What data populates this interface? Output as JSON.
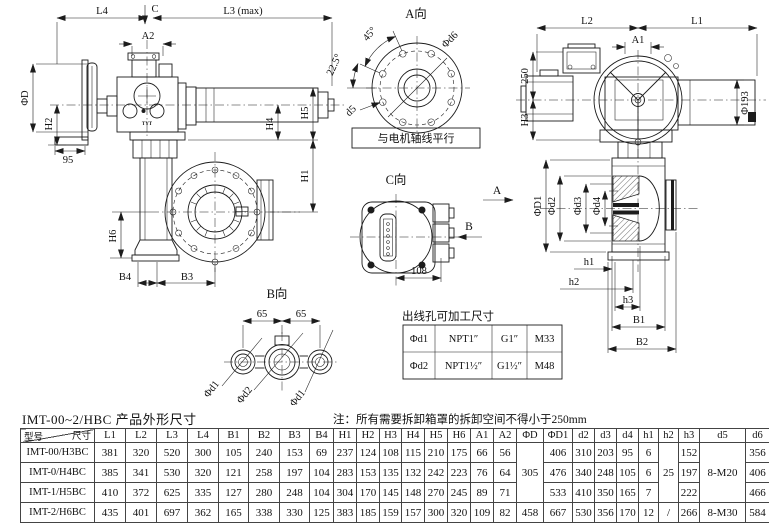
{
  "title": "IMT-00~2/HBC 产品外形尺寸",
  "note": "注：所有需要拆卸箱罩的拆卸空间不得小于250mm",
  "labels": {
    "l4": "L4",
    "c": "C",
    "l3max": "L3 (max)",
    "a2": "A2",
    "phi_d": "ΦD",
    "h2": "H2",
    "n95": "95",
    "h4": "H4",
    "h5": "H5",
    "h1": "H1",
    "h6": "H6",
    "b4": "B4",
    "b3": "B3",
    "brand": "TYT",
    "a_view": "A向",
    "deg45": "45°",
    "deg225": "22.5°",
    "phi_d6": "Φd6",
    "d5": "d5",
    "motor_axis_note": "与电机轴线平行",
    "l2": "L2",
    "l1": "L1",
    "a1": "A1",
    "n250": "250",
    "h3": "H3",
    "phi193": "Φ193",
    "sec_a": "A",
    "phi_d1_cap": "ΦD1",
    "phi_d2": "Φd2",
    "phi_d3": "Φd3",
    "phi_d4": "Φd4",
    "sh1": "h1",
    "sh2": "h2",
    "sh3": "h3",
    "b1": "B1",
    "b2": "B2",
    "c_view": "C向",
    "b_arrow": "B",
    "n108": "108",
    "b_view": "B向",
    "n65a": "65",
    "n65b": "65",
    "g_d1a": "Φd1",
    "g_d2": "Φd2",
    "g_d1b": "Φd1"
  },
  "outlet_table": {
    "title": "出线孔可加工尺寸",
    "rows": [
      [
        "Φd1",
        "NPT1″",
        "G1″",
        "M33"
      ],
      [
        "Φd2",
        "NPT1½″",
        "G1½″",
        "M48"
      ]
    ]
  },
  "main_table": {
    "corner_top": "尺寸",
    "corner_bottom": "型号",
    "headers": [
      "L1",
      "L2",
      "L3",
      "L4",
      "B1",
      "B2",
      "B3",
      "B4",
      "H1",
      "H2",
      "H3",
      "H4",
      "H5",
      "H6",
      "A1",
      "A2",
      "ΦD",
      "ΦD1",
      "d2",
      "d3",
      "d4",
      "h1",
      "h2",
      "h3",
      "d5",
      "d6"
    ],
    "rows": [
      {
        "model": "IMT-00/H3BC",
        "values": [
          "381",
          "320",
          "520",
          "300",
          "105",
          "240",
          "153",
          "69",
          "237",
          "124",
          "108",
          "115",
          "210",
          "175",
          "66",
          "56",
          [
            "305",
            3
          ],
          "406",
          "310",
          "203",
          "95",
          "6",
          [
            "25",
            3
          ],
          "152",
          [
            "8-M20",
            3
          ],
          "356"
        ]
      },
      {
        "model": "IMT-0/H4BC",
        "values": [
          "385",
          "341",
          "530",
          "320",
          "121",
          "258",
          "197",
          "104",
          "283",
          "153",
          "135",
          "132",
          "242",
          "223",
          "76",
          "64",
          null,
          "476",
          "340",
          "248",
          "105",
          "6",
          null,
          "197",
          null,
          "406"
        ]
      },
      {
        "model": "IMT-1/H5BC",
        "values": [
          "410",
          "372",
          "625",
          "335",
          "127",
          "280",
          "248",
          "104",
          "304",
          "170",
          "145",
          "148",
          "270",
          "245",
          "89",
          "71",
          null,
          "533",
          "410",
          "350",
          "165",
          "7",
          null,
          "222",
          null,
          "466"
        ]
      },
      {
        "model": "IMT-2/H6BC",
        "values": [
          "435",
          "401",
          "697",
          "362",
          "165",
          "338",
          "330",
          "125",
          "383",
          "185",
          "159",
          "157",
          "300",
          "320",
          "109",
          "82",
          "458",
          "667",
          "530",
          "356",
          "170",
          "12",
          "/",
          "266",
          "8-M30",
          "584"
        ]
      }
    ]
  }
}
